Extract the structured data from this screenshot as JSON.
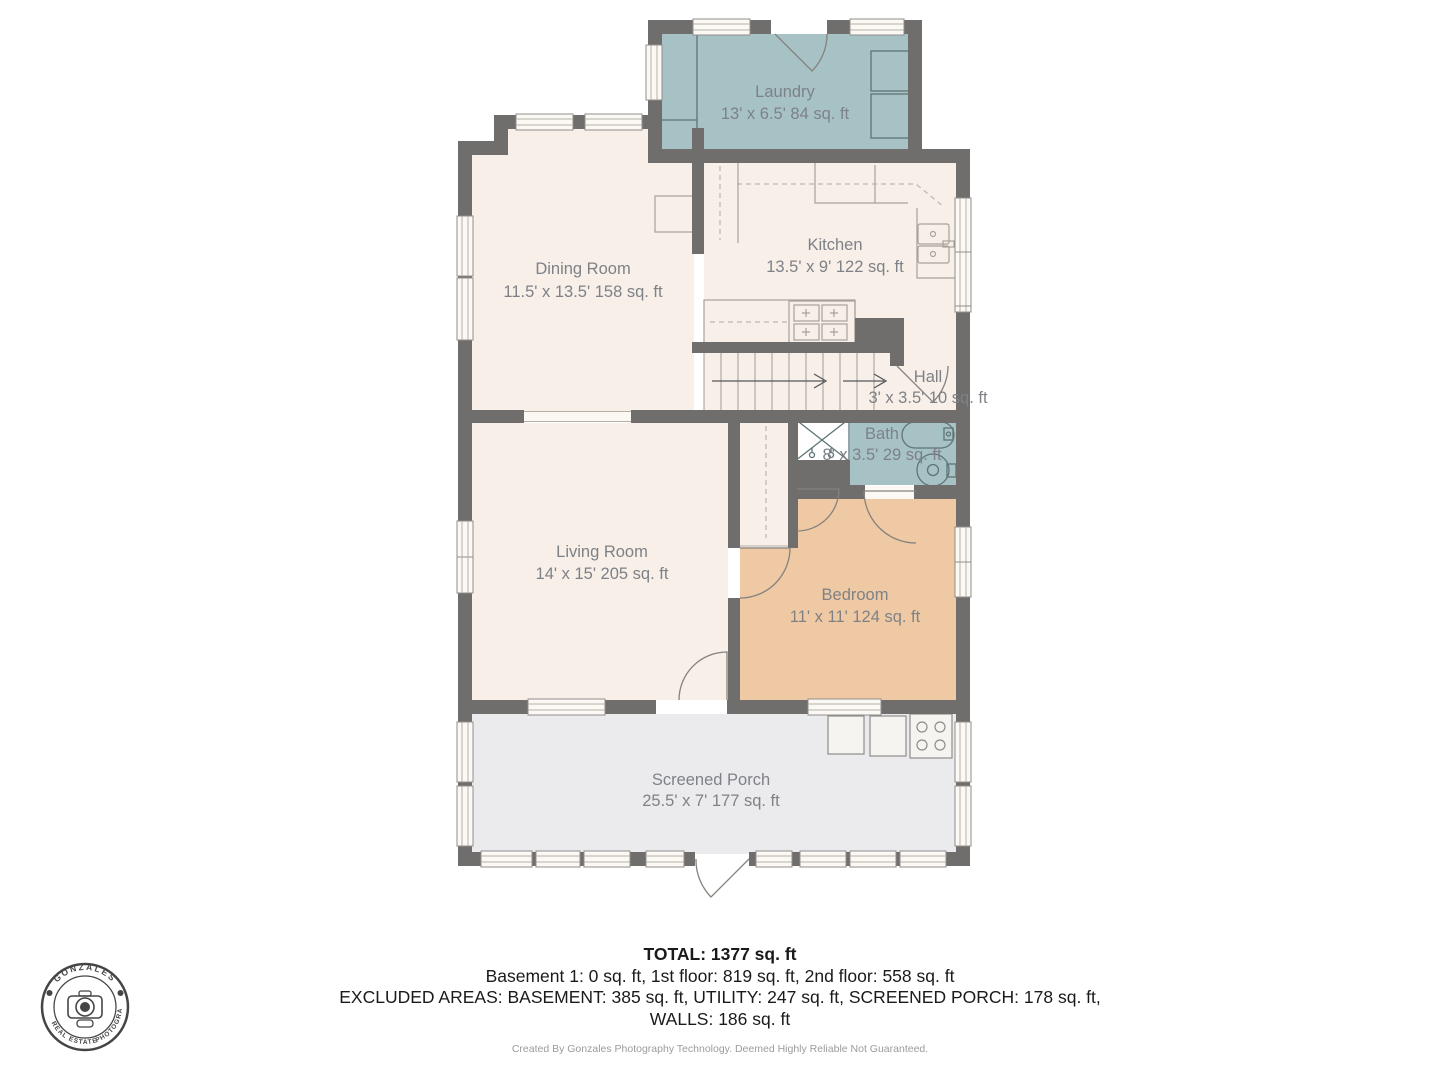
{
  "plan": {
    "rooms": [
      {
        "id": "laundry",
        "name": "Laundry",
        "dims": "13' x 6.5' 84 sq. ft"
      },
      {
        "id": "dining",
        "name": "Dining Room",
        "dims": "11.5' x 13.5' 158 sq. ft"
      },
      {
        "id": "kitchen",
        "name": "Kitchen",
        "dims": "13.5' x 9' 122 sq. ft"
      },
      {
        "id": "hall",
        "name": "Hall",
        "dims": "3' x 3.5' 10 sq. ft"
      },
      {
        "id": "bath",
        "name": "Bath",
        "dims": "8' x 3.5' 29 sq. ft"
      },
      {
        "id": "living",
        "name": "Living Room",
        "dims": "14' x 15' 205 sq. ft"
      },
      {
        "id": "bedroom",
        "name": "Bedroom",
        "dims": "11' x 11' 124 sq. ft"
      },
      {
        "id": "porch",
        "name": "Screened Porch",
        "dims": "25.5' x 7' 177 sq. ft"
      }
    ]
  },
  "summary": {
    "total": "TOTAL: 1377 sq. ft",
    "floors": "Basement 1: 0 sq. ft, 1st floor: 819 sq. ft, 2nd floor: 558 sq. ft",
    "excluded": "EXCLUDED AREAS: BASEMENT: 385 sq. ft, UTILITY: 247 sq. ft, SCREENED PORCH: 178 sq. ft,",
    "walls": "WALLS: 186 sq. ft",
    "credit": "Created By Gonzales Photography Technology. Deemed Highly Reliable Not Guaranteed."
  },
  "logo": {
    "top": "GONZALES",
    "bottom_left": "REAL ESTATE",
    "bottom_right": "PHOTOGRAPHY"
  },
  "colors": {
    "wall": "#6f6e6c",
    "floor": "#f7efe8",
    "wet_room": "#a7c2c4",
    "bedroom": "#efc9a3",
    "porch": "#ebebed",
    "label_text": "#7e8187",
    "summary_text": "#1a1a1a"
  }
}
